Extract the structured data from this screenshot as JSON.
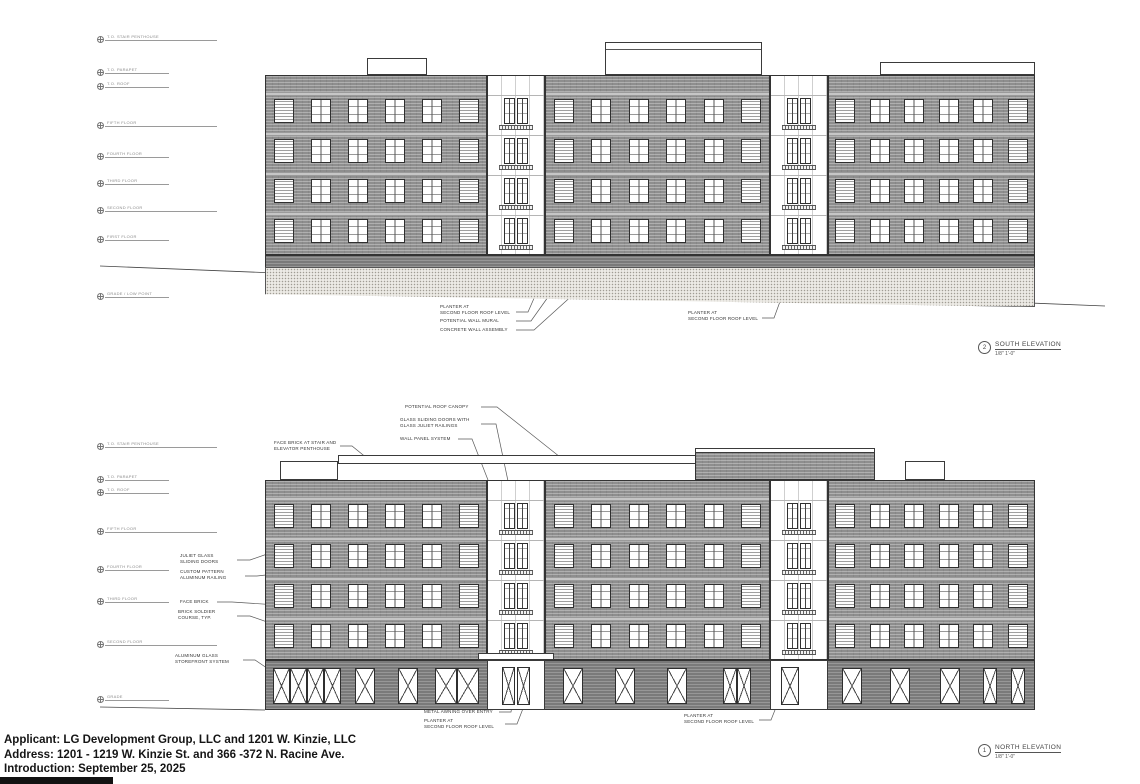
{
  "sheet": {
    "footer": {
      "applicant": "Applicant: LG Development Group, LLC and 1201 W. Kinzie, LLC",
      "address": "Address: 1201 - 1219 W. Kinzie St. and 366 -372 N. Racine Ave.",
      "introduction": "Introduction: September 25, 2025"
    }
  },
  "elevations": [
    {
      "id": "south",
      "number": "2",
      "title": "SOUTH ELEVATION",
      "scale": "1/8\" 1'-0\"",
      "annotations": [
        "PLANTER AT\nSECOND FLOOR ROOF LEVEL",
        "POTENTIAL WALL MURAL",
        "CONCRETE WALL ASSEMBLY",
        "PLANTER AT\nSECOND FLOOR ROOF LEVEL"
      ],
      "levels": [
        "T.O. STAIR PENTHOUSE",
        "T.O. PARAPET",
        "T.O. ROOF",
        "FIFTH FLOOR",
        "FOURTH FLOOR",
        "THIRD FLOOR",
        "SECOND FLOOR",
        "FIRST FLOOR",
        "GRADE / LOW POINT"
      ]
    },
    {
      "id": "north",
      "number": "1",
      "title": "NORTH ELEVATION",
      "scale": "1/8\" 1'-0\"",
      "annotations": [
        "POTENTIAL ROOF CANOPY",
        "GLASS SLIDING DOORS WITH\nGLASS JULIET RAILINGS",
        "WALL PANEL SYSTEM",
        "FACE BRICK AT STAIR AND\nELEVATOR PENTHOUSE",
        "JULIET GLASS\nSLIDING DOORS",
        "CUSTOM PATTERN\nALUMINUM RAILING",
        "FACE BRICK",
        "BRICK SOLDIER\nCOURSE, TYP.",
        "ALUMINUM GLASS\nSTOREFRONT SYSTEM",
        "METAL AWNING OVER ENTRY",
        "PLANTER AT\nSECOND FLOOR ROOF LEVEL",
        "PLANTER AT\nSECOND FLOOR ROOF LEVEL"
      ],
      "levels": [
        "T.O. STAIR PENTHOUSE",
        "T.O. PARAPET",
        "T.O. ROOF",
        "FIFTH FLOOR",
        "FOURTH FLOOR",
        "THIRD FLOOR",
        "SECOND FLOOR",
        "GRADE"
      ]
    }
  ]
}
